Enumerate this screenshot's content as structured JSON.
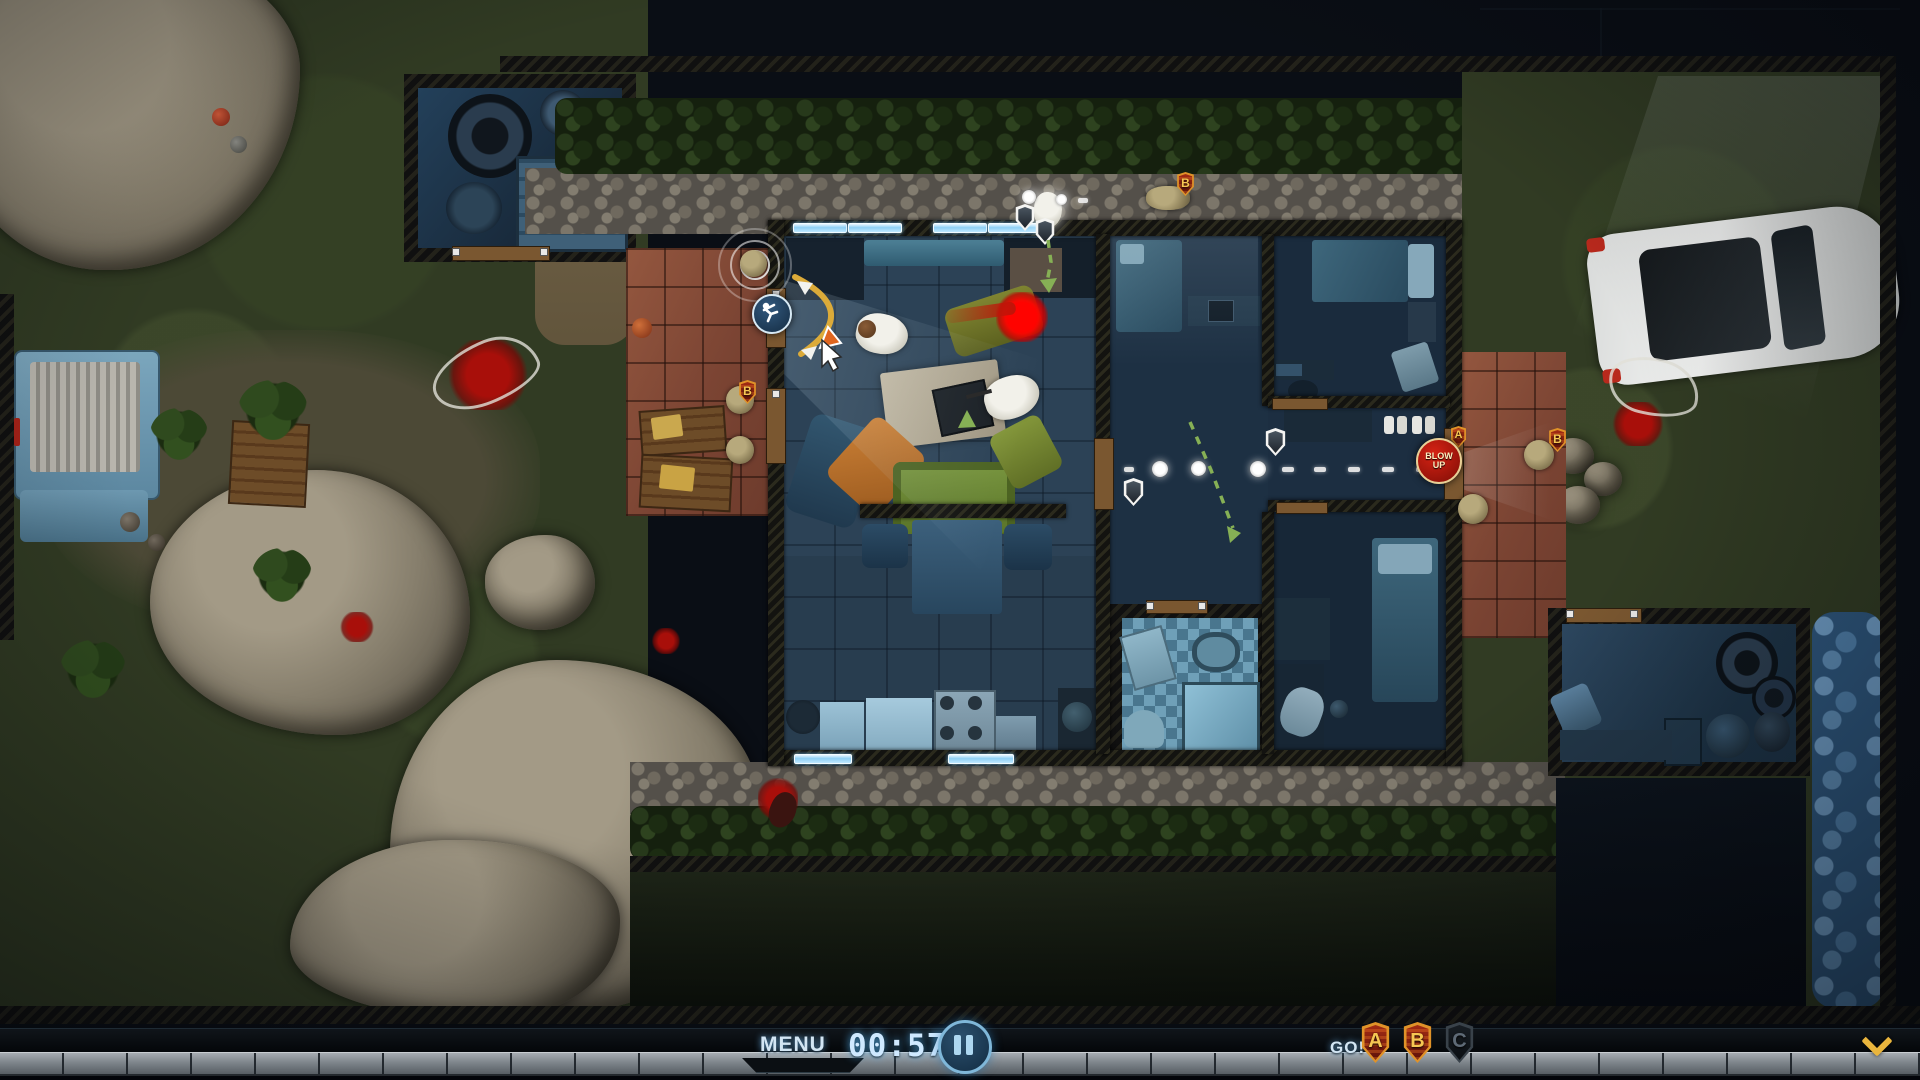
{
  "hud": {
    "menu_label": "MENU",
    "timer_value": "00:57",
    "go_label": "GO!",
    "squad_badges": [
      {
        "label": "A",
        "state": "active"
      },
      {
        "label": "B",
        "state": "active"
      },
      {
        "label": "C",
        "state": "inactive"
      }
    ],
    "icons": {
      "pause": "pause-icon",
      "collapse": "chevron-down-icon"
    },
    "colors": {
      "hud_text_blue": "#d3e6f4",
      "timer_blue": "#cfe9ff",
      "badge_active_fill": "#a42c14",
      "badge_active_border": "#e09228",
      "badge_letter_gold": "#f6c752",
      "badge_inactive_fill": "#101418",
      "chevron_gold": "#e9b53d",
      "timeline_gray": "#7e858b"
    }
  },
  "map": {
    "blow_up_order": {
      "label": "BLOW UP",
      "color": "#c0160f"
    },
    "order_badges": [
      {
        "label": "B",
        "location": "left-patio-door"
      },
      {
        "label": "B",
        "location": "top-path"
      },
      {
        "label": "A",
        "location": "right-door-blow-up"
      },
      {
        "label": "B",
        "location": "right-patio"
      }
    ],
    "path_colors": {
      "waypoint_white": "#ffffff",
      "go_code_green": "#86b055",
      "aim_arc_gold": "#dcab39"
    }
  },
  "icons": [
    "pause-icon",
    "chevron-down-icon",
    "squad-shield-badge",
    "shield-marker-icon",
    "waypoint-dot",
    "flashbang-throw-icon",
    "aim-arc",
    "cursor-icon",
    "sonar-ripple"
  ]
}
